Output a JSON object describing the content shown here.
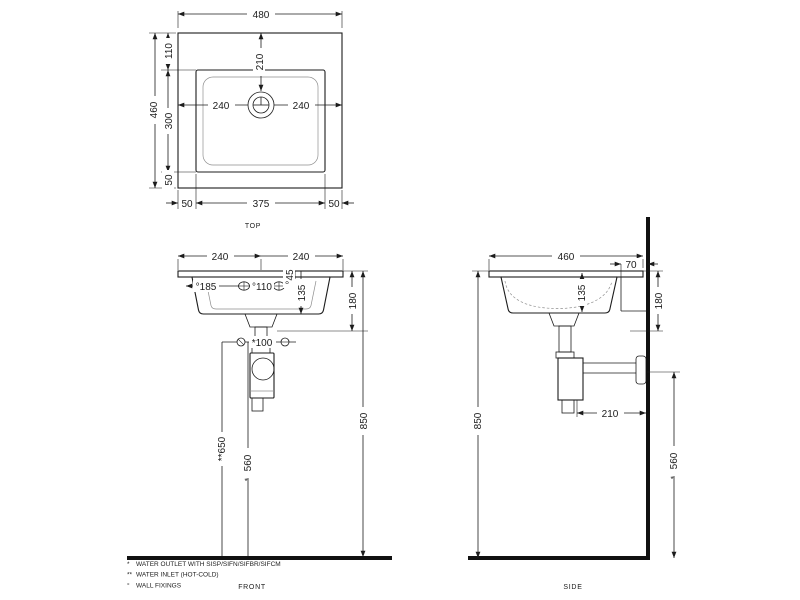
{
  "drawing": {
    "colors": {
      "line": "#1c1c1c",
      "light_line": "#8f8f8f",
      "background": "#ffffff"
    },
    "views": {
      "top": {
        "caption": "TOP",
        "dims": {
          "overall_width": "480",
          "overall_depth": "460",
          "back_band": "110",
          "basin_depth": "300",
          "front_band": "50",
          "bottom_left": "50",
          "basin_width": "375",
          "bottom_right": "50",
          "faucet_from_back": "210",
          "faucet_left": "240",
          "faucet_right": "240"
        }
      },
      "front": {
        "caption": "FRONT",
        "dims": {
          "half_left": "240",
          "half_right": "240",
          "inlet_from_edge": "°185",
          "inlet_spacing": "°110",
          "inlet_drop": "°45",
          "bowl_depth": "135",
          "fixing_spacing": "*100",
          "body_height": "180",
          "rim_height": "850",
          "inlet_height": "**650",
          "outlet_height": "560",
          "outlet_height_marker": "*"
        }
      },
      "side": {
        "caption": "SIDE",
        "dims": {
          "overall_depth": "460",
          "back_offset": "70",
          "bowl_depth": "135",
          "body_height": "180",
          "rim_height": "850",
          "trap_to_wall": "210",
          "outlet_height": "560",
          "outlet_height_marker": "*"
        }
      }
    },
    "footnotes": [
      {
        "marker": "*",
        "text": "WATER OUTLET WITH SISP/SIFN/SIFBR/SIFCM"
      },
      {
        "marker": "**",
        "text": "WATER INLET  (HOT-COLD)"
      },
      {
        "marker": "°",
        "text": "WALL FIXINGS"
      }
    ]
  }
}
